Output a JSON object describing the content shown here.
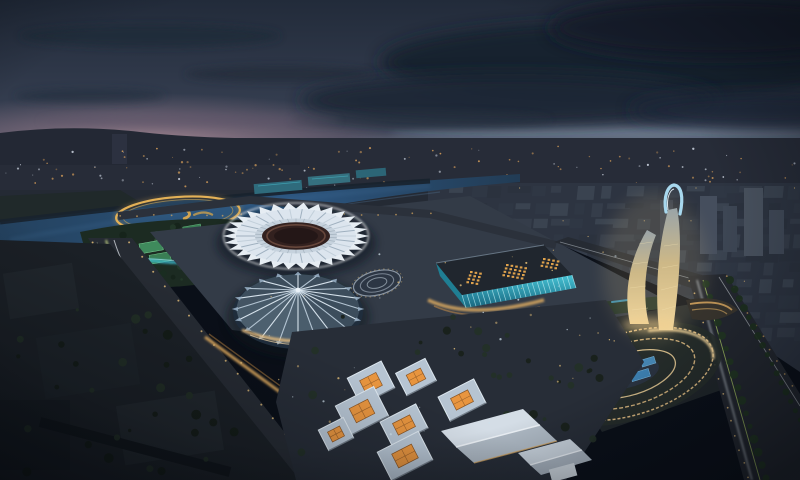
{
  "scene": {
    "type": "aerial-architectural-rendering",
    "time_of_day": "dusk",
    "description": "Aerial dusk rendering of a riverside Olympic sports park: golden ring bridge over a lake, white petal-roof stadium, radial tent-dome arena, teal-glass convention center with glowing roof skylights, twin curved lattice tower with looped crown, oval sunken plaza with concentric lights, warm courtyard pavilions in the foreground, lit boulevards and a distant city skyline under heavy blue clouds.",
    "landmarks": [
      "ring-bridge-over-lake",
      "petal-roof-stadium",
      "tent-dome-arena",
      "convention-center",
      "twin-curved-tower",
      "sunken-oval-plaza",
      "courtyard-pavilions",
      "gabled-exhibition-hall",
      "riverside-park",
      "main-boulevard",
      "east-boulevard",
      "city-skyline",
      "river"
    ]
  },
  "palette": {
    "sky_top": "#222b3a",
    "sky_mid": "#394153",
    "horizon_glow": "#a98a95",
    "cloud_dark": "#16202f",
    "land_dark": "#272c38",
    "water": "#2a4f78",
    "park_green": "#1c2b22",
    "court_green": "#48a06a",
    "channel_cyan": "#3ec2de",
    "road_dark": "#262b33",
    "warm_light": "#e8c27a",
    "amber_glow": "#d9a860",
    "cool_light": "#dfe8f0",
    "teal_glass": "#2fa6ba",
    "roof_white": "#e6edf3",
    "dome_blue": "#6f8ca2",
    "courtyard_glow": "#e8953f",
    "ring_gold": "#e3b157",
    "trail_green": "#cfe08a"
  }
}
